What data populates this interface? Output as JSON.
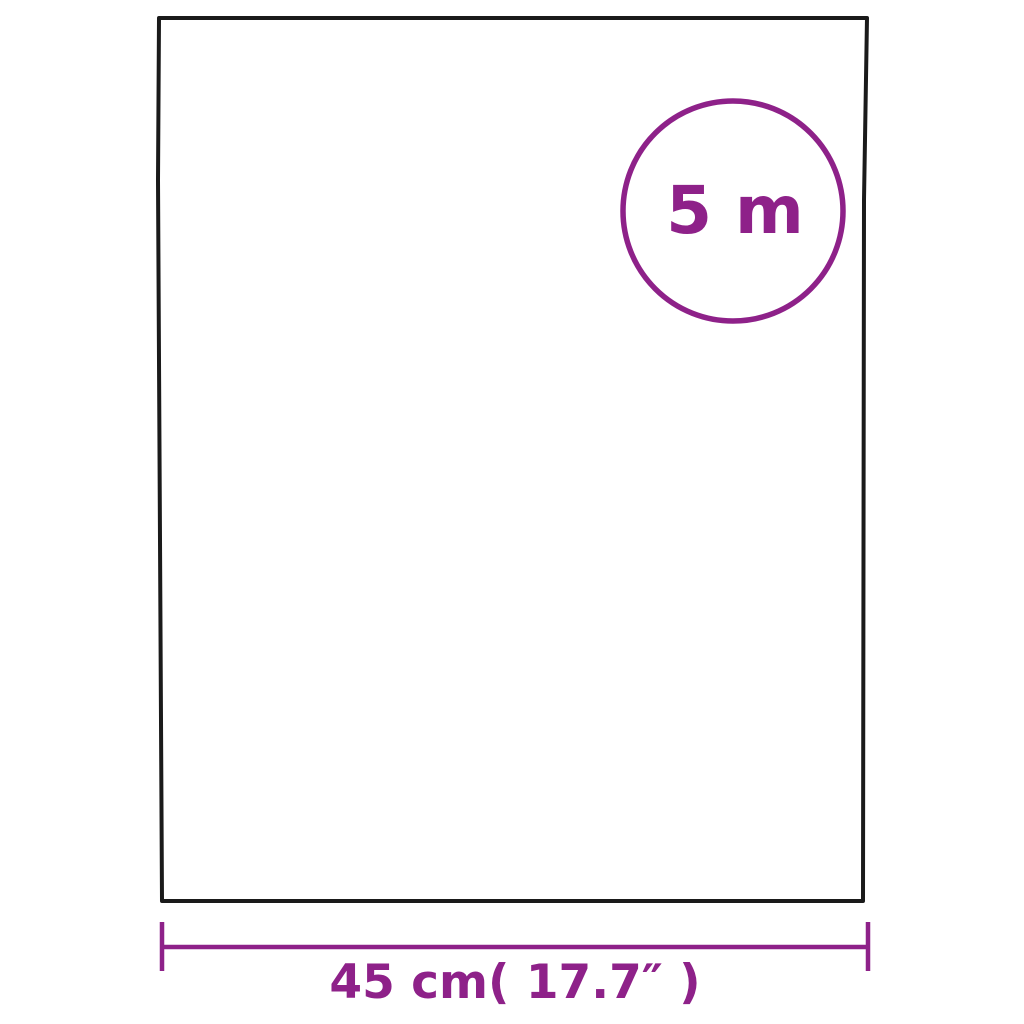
{
  "diagram": {
    "title": "product-dimension-diagram",
    "length_badge": {
      "label": "5 m"
    },
    "width_dimension": {
      "label": "45 cm( 17.7″ )"
    },
    "colors": {
      "accent_purple": "#8E2189",
      "outline_black": "#1A1A1A",
      "background": "#FFFFFF"
    }
  }
}
